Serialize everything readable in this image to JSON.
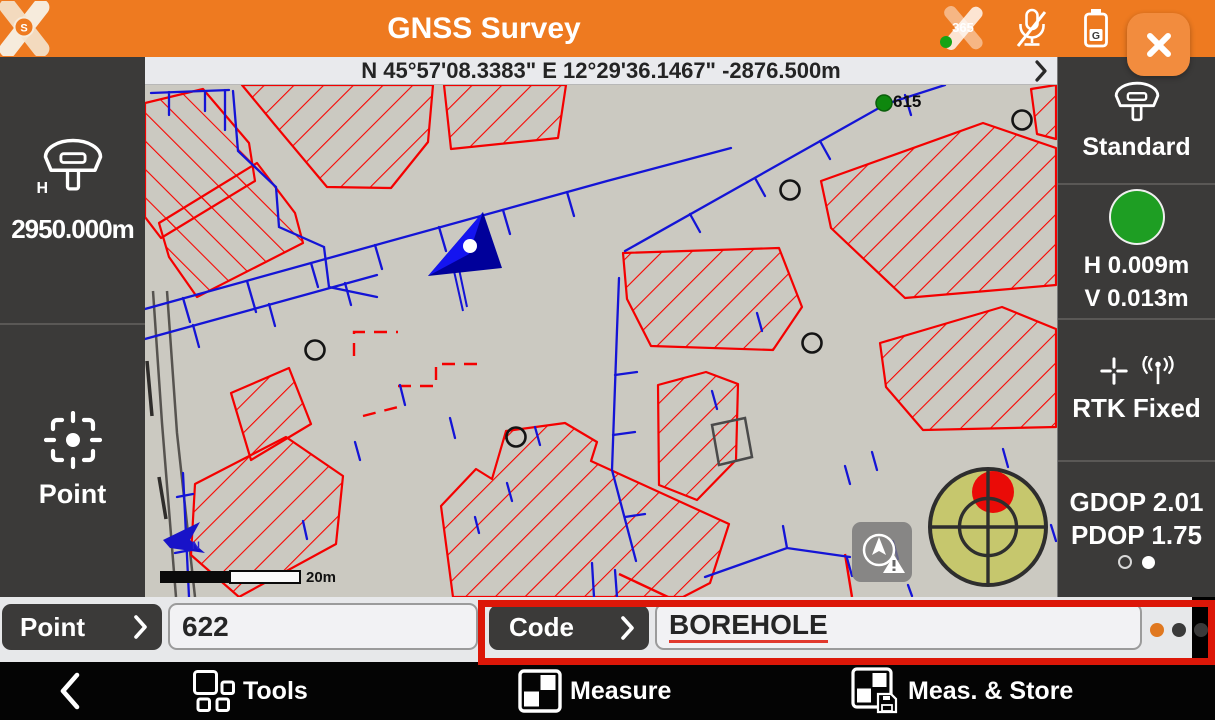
{
  "header": {
    "title": "GNSS Survey",
    "logo_letter": "S",
    "cloud_badge": "365",
    "battery_letter": "G"
  },
  "status_bar": {
    "coordinates": "N 45°57'08.3383\" E 12°29'36.1467\" -2876.500m"
  },
  "left_panel": {
    "antenna_h_sub": "H",
    "antenna_height": "2950.000m",
    "point_label": "Point"
  },
  "right_panel": {
    "profile": "Standard",
    "h_accuracy": "H 0.009m",
    "v_accuracy": "V 0.013m",
    "fix_status": "RTK Fixed",
    "gdop": "GDOP 2.01",
    "pdop": "PDOP 1.75"
  },
  "map": {
    "point_label_615": "615",
    "scale_label": "20m",
    "north_label": "N"
  },
  "fields": {
    "point_label": "Point",
    "point_value": "622",
    "code_label": "Code",
    "code_value": "BOREHOLE"
  },
  "nav": {
    "tools": "Tools",
    "measure": "Measure",
    "meas_store": "Meas. & Store"
  },
  "colors": {
    "accent_orange": "#EE7A20",
    "annotation_red": "#DC1708",
    "fix_green": "#1E9E23",
    "map_red": "#F40000",
    "map_blue": "#1414D6",
    "level_fill": "#C6C76D"
  }
}
